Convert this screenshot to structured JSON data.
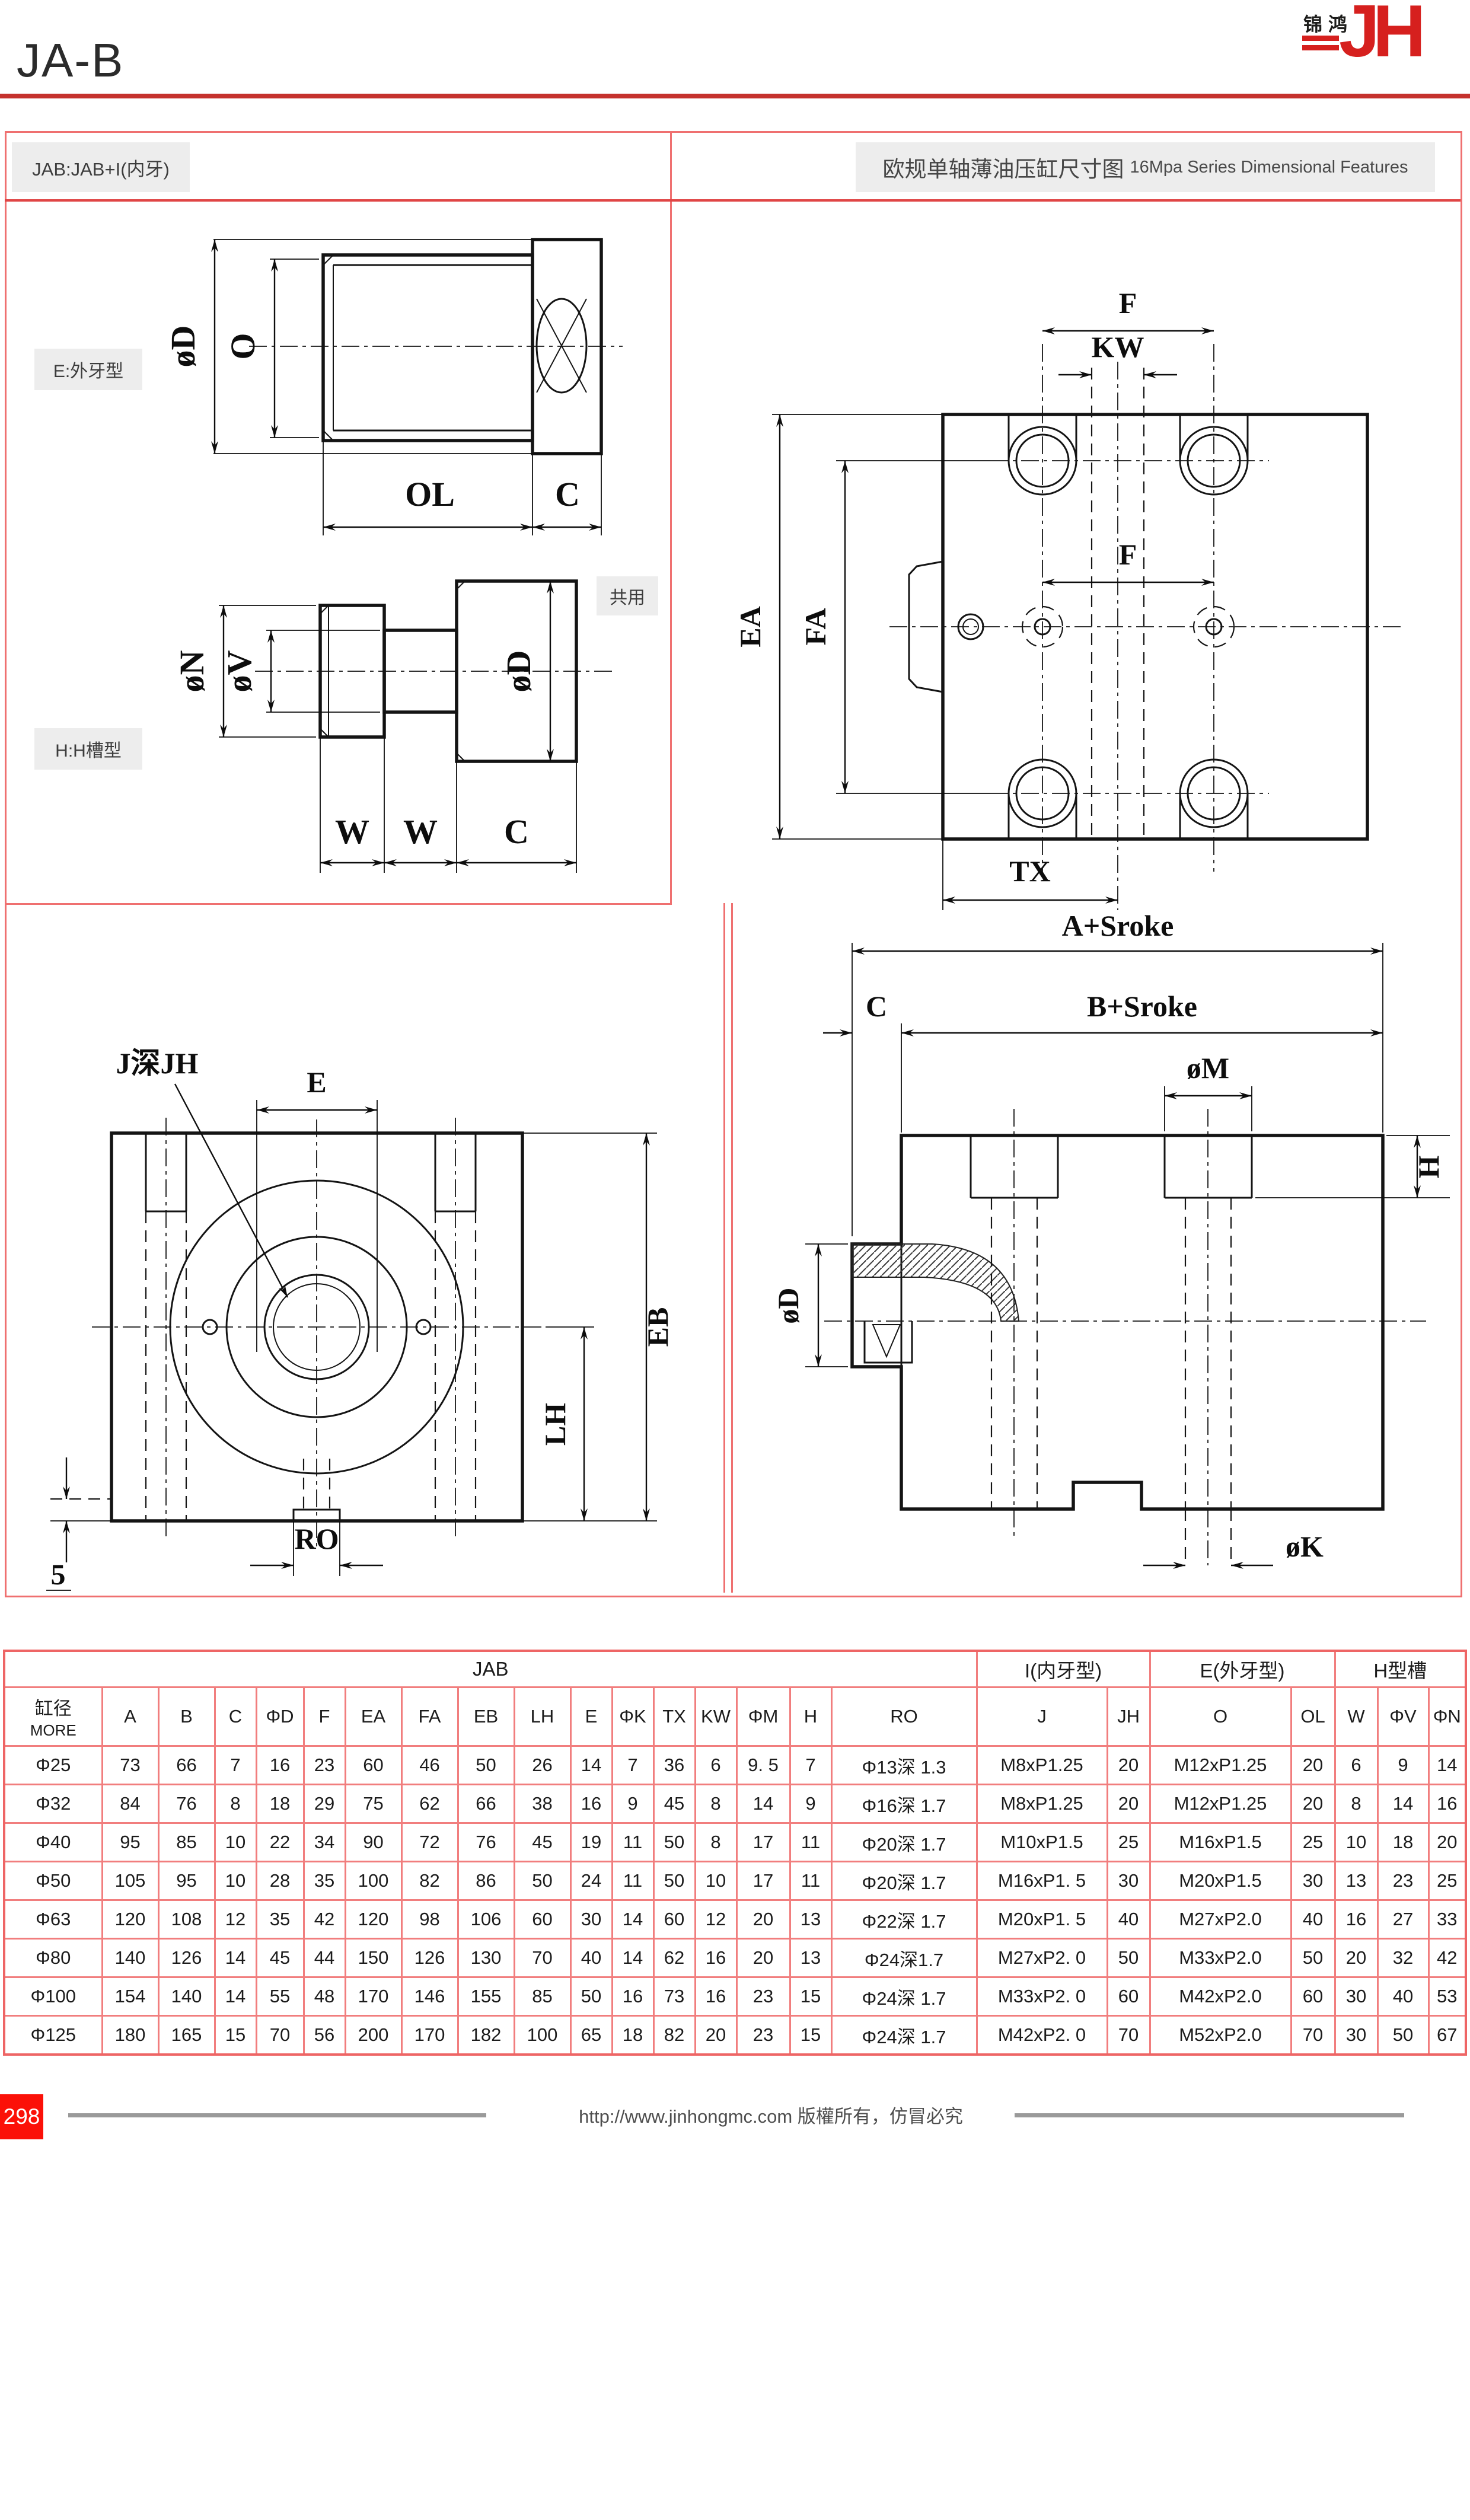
{
  "page": {
    "title": "JA-B",
    "page_number": "298",
    "footer_text": "http://www.jinhongmc.com 版權所有，仿冒必究"
  },
  "logo": {
    "cn": "锦鸿",
    "latin": "JH"
  },
  "labels": {
    "model": "JAB:JAB+I(内牙)",
    "section_cn": "欧规单轴薄油压缸尺寸图",
    "section_en": "16Mpa Series Dimensional Features",
    "e_type": "E:外牙型",
    "common": "共用",
    "h_type": "H:H槽型"
  },
  "dims": {
    "e_view": {
      "d": "øD",
      "o": "O",
      "ol": "OL",
      "c": "C"
    },
    "h_view": {
      "n": "øN",
      "v": "øV",
      "d": "øD",
      "w1": "W",
      "w2": "W",
      "c": "C"
    },
    "top_view": {
      "f_top": "F",
      "kw": "KW",
      "f_mid": "F",
      "ea": "EA",
      "fa": "FA",
      "tx": "TX"
    },
    "front_view": {
      "j": "J深JH",
      "e": "E",
      "eb": "EB",
      "lh": "LH",
      "ro": "RO",
      "five": "5"
    },
    "section_view": {
      "a": "A+Sroke",
      "c": "C",
      "b": "B+Sroke",
      "m": "øM",
      "h": "H",
      "d": "øD",
      "k": "øK"
    }
  },
  "table": {
    "groups": [
      {
        "label": "JAB",
        "span": 17
      },
      {
        "label": "I(内牙型)",
        "span": 2
      },
      {
        "label": "E(外牙型)",
        "span": 2
      },
      {
        "label": "H型槽",
        "span": 3
      }
    ],
    "bore_header": {
      "line1": "缸径",
      "line2": "MORE"
    },
    "columns": [
      "A",
      "B",
      "C",
      "ΦD",
      "F",
      "EA",
      "FA",
      "EB",
      "LH",
      "E",
      "ΦK",
      "TX",
      "KW",
      "ΦM",
      "H",
      "RO",
      "J",
      "JH",
      "O",
      "OL",
      "W",
      "ΦV",
      "ΦN"
    ],
    "rows": [
      {
        "bore": "Φ25",
        "values": [
          "73",
          "66",
          "7",
          "16",
          "23",
          "60",
          "46",
          "50",
          "26",
          "14",
          "7",
          "36",
          "6",
          "9. 5",
          "7",
          "Φ13深 1.3",
          "M8xP1.25",
          "20",
          "M12xP1.25",
          "20",
          "6",
          "9",
          "14"
        ]
      },
      {
        "bore": "Φ32",
        "values": [
          "84",
          "76",
          "8",
          "18",
          "29",
          "75",
          "62",
          "66",
          "38",
          "16",
          "9",
          "45",
          "8",
          "14",
          "9",
          "Φ16深 1.7",
          "M8xP1.25",
          "20",
          "M12xP1.25",
          "20",
          "8",
          "14",
          "16"
        ]
      },
      {
        "bore": "Φ40",
        "values": [
          "95",
          "85",
          "10",
          "22",
          "34",
          "90",
          "72",
          "76",
          "45",
          "19",
          "11",
          "50",
          "8",
          "17",
          "11",
          "Φ20深 1.7",
          "M10xP1.5",
          "25",
          "M16xP1.5",
          "25",
          "10",
          "18",
          "20"
        ]
      },
      {
        "bore": "Φ50",
        "values": [
          "105",
          "95",
          "10",
          "28",
          "35",
          "100",
          "82",
          "86",
          "50",
          "24",
          "11",
          "50",
          "10",
          "17",
          "11",
          "Φ20深 1.7",
          "M16xP1. 5",
          "30",
          "M20xP1.5",
          "30",
          "13",
          "23",
          "25"
        ]
      },
      {
        "bore": "Φ63",
        "values": [
          "120",
          "108",
          "12",
          "35",
          "42",
          "120",
          "98",
          "106",
          "60",
          "30",
          "14",
          "60",
          "12",
          "20",
          "13",
          "Φ22深 1.7",
          "M20xP1. 5",
          "40",
          "M27xP2.0",
          "40",
          "16",
          "27",
          "33"
        ]
      },
      {
        "bore": "Φ80",
        "values": [
          "140",
          "126",
          "14",
          "45",
          "44",
          "150",
          "126",
          "130",
          "70",
          "40",
          "14",
          "62",
          "16",
          "20",
          "13",
          "Φ24深1.7",
          "M27xP2. 0",
          "50",
          "M33xP2.0",
          "50",
          "20",
          "32",
          "42"
        ]
      },
      {
        "bore": "Φ100",
        "values": [
          "154",
          "140",
          "14",
          "55",
          "48",
          "170",
          "146",
          "155",
          "85",
          "50",
          "16",
          "73",
          "16",
          "23",
          "15",
          "Φ24深 1.7",
          "M33xP2. 0",
          "60",
          "M42xP2.0",
          "60",
          "30",
          "40",
          "53"
        ]
      },
      {
        "bore": "Φ125",
        "values": [
          "180",
          "165",
          "15",
          "70",
          "56",
          "200",
          "170",
          "182",
          "100",
          "65",
          "18",
          "82",
          "20",
          "23",
          "15",
          "Φ24深 1.7",
          "M42xP2. 0",
          "70",
          "M52xP2.0",
          "70",
          "30",
          "50",
          "67"
        ]
      }
    ]
  },
  "colors": {
    "accent_red": "#d6201e",
    "table_border_red": "#f17e7e",
    "frame_red": "#ef7070",
    "title_rule_red": "#c5322d",
    "footer_red": "#fb1108",
    "label_bg": "#ededed"
  }
}
